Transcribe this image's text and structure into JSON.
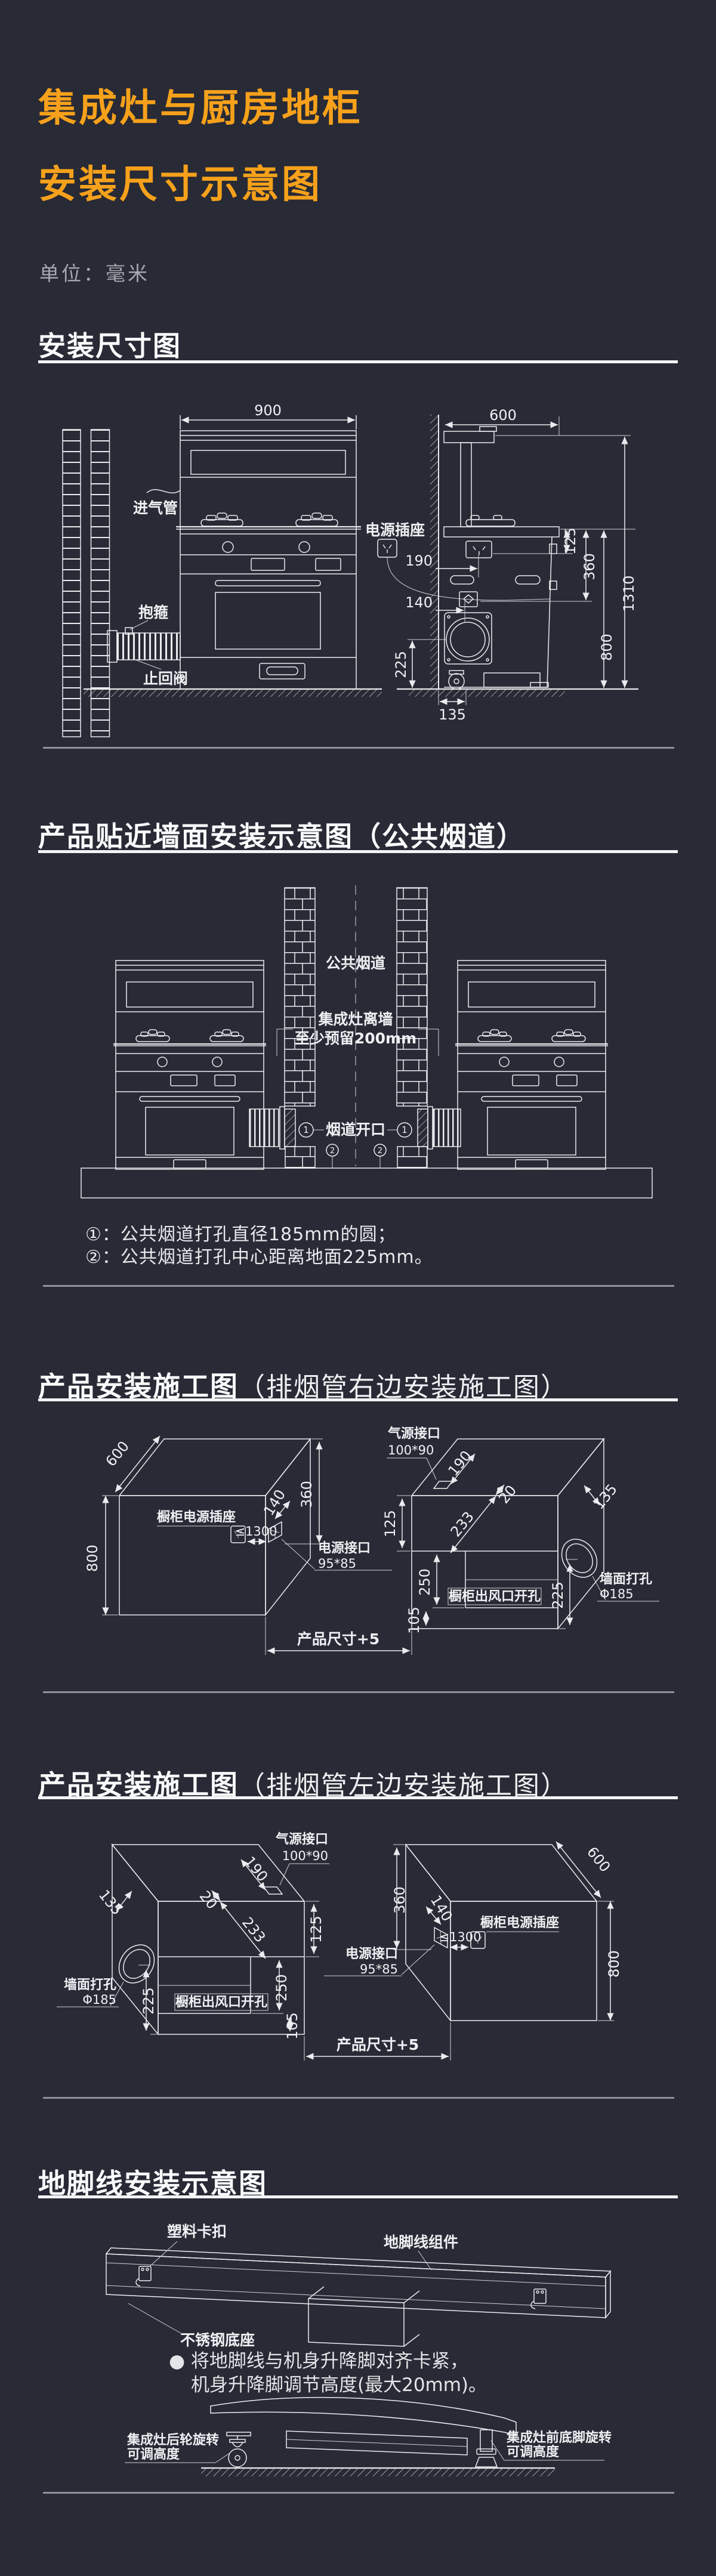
{
  "colors": {
    "background": "#282a35",
    "accent_orange": "#f6a11b",
    "line_white": "#e9ebee",
    "divider_gray": "#8f929a"
  },
  "header": {
    "title_line1": "集成灶与厨房地柜",
    "title_line2": "安装尺寸示意图",
    "unit": "单位：毫米"
  },
  "s1": {
    "title": "安装尺寸图",
    "d900": "900",
    "d600": "600",
    "socket": "电源插座",
    "d190": "190",
    "d140": "140",
    "gas_inlet": "进气管",
    "clamp": "抱箍",
    "check_valve": "止回阀",
    "d125": "125",
    "d360": "360",
    "d800": "800",
    "d1310": "1310",
    "d225": "225",
    "d135": "135"
  },
  "s2": {
    "title": "产品贴近墙面安装示意图（公共烟道）",
    "flue": "公共烟道",
    "gap_line1": "集成灶离墙",
    "gap_line2": "至少预留200mm",
    "opening": "烟道开口",
    "mark1": "1",
    "mark2": "2",
    "note1": "①：公共烟道打孔直径185mm的圆；",
    "note2": "②：公共烟道打孔中心距离地面225mm。"
  },
  "s3": {
    "title_main": "产品安装施工图",
    "title_paren": "（排烟管右边安装施工图）",
    "d600": "600",
    "d800": "800",
    "d360": "360",
    "d140": "140",
    "cab_socket": "橱柜电源插座",
    "max1300": "≤1300",
    "power_port": "电源接口",
    "power_size": "95*85",
    "gas_port": "气源接口",
    "gas_size": "100*90",
    "d190": "190",
    "d125": "125",
    "d233": "233",
    "d20": "20",
    "d135": "135",
    "d250": "250",
    "d225": "225",
    "d105": "105",
    "outlet_cut": "橱柜出风口开孔",
    "wall_hole": "墙面打孔",
    "hole_dia": "Φ185",
    "product_dim": "产品尺寸+5"
  },
  "s4": {
    "title_main": "产品安装施工图",
    "title_paren": "（排烟管左边安装施工图）",
    "d600": "600",
    "d800": "800",
    "d360": "360",
    "d140": "140",
    "cab_socket": "橱柜电源插座",
    "max1300": "≤1300",
    "power_port": "电源接口",
    "power_size": "95*85",
    "gas_port": "气源接口",
    "gas_size": "100*90",
    "d190": "190",
    "d125": "125",
    "d233": "233",
    "d20": "20",
    "d135": "135",
    "d250": "250",
    "d225": "225",
    "d105": "105",
    "outlet_cut": "橱柜出风口开孔",
    "wall_hole": "墙面打孔",
    "hole_dia": "Φ185",
    "product_dim": "产品尺寸+5"
  },
  "s5": {
    "title": "地脚线安装示意图",
    "clip": "塑料卡扣",
    "assembly": "地脚线组件",
    "base": "不锈钢底座",
    "bullet": "●",
    "note_line1": "将地脚线与机身升降脚对齐卡紧，",
    "note_line2": "机身升降脚调节高度(最大20mm)。",
    "rear_label1": "集成灶后轮旋转",
    "rear_label2": "可调高度",
    "front_label1": "集成灶前底脚旋转",
    "front_label2": "可调高度"
  }
}
